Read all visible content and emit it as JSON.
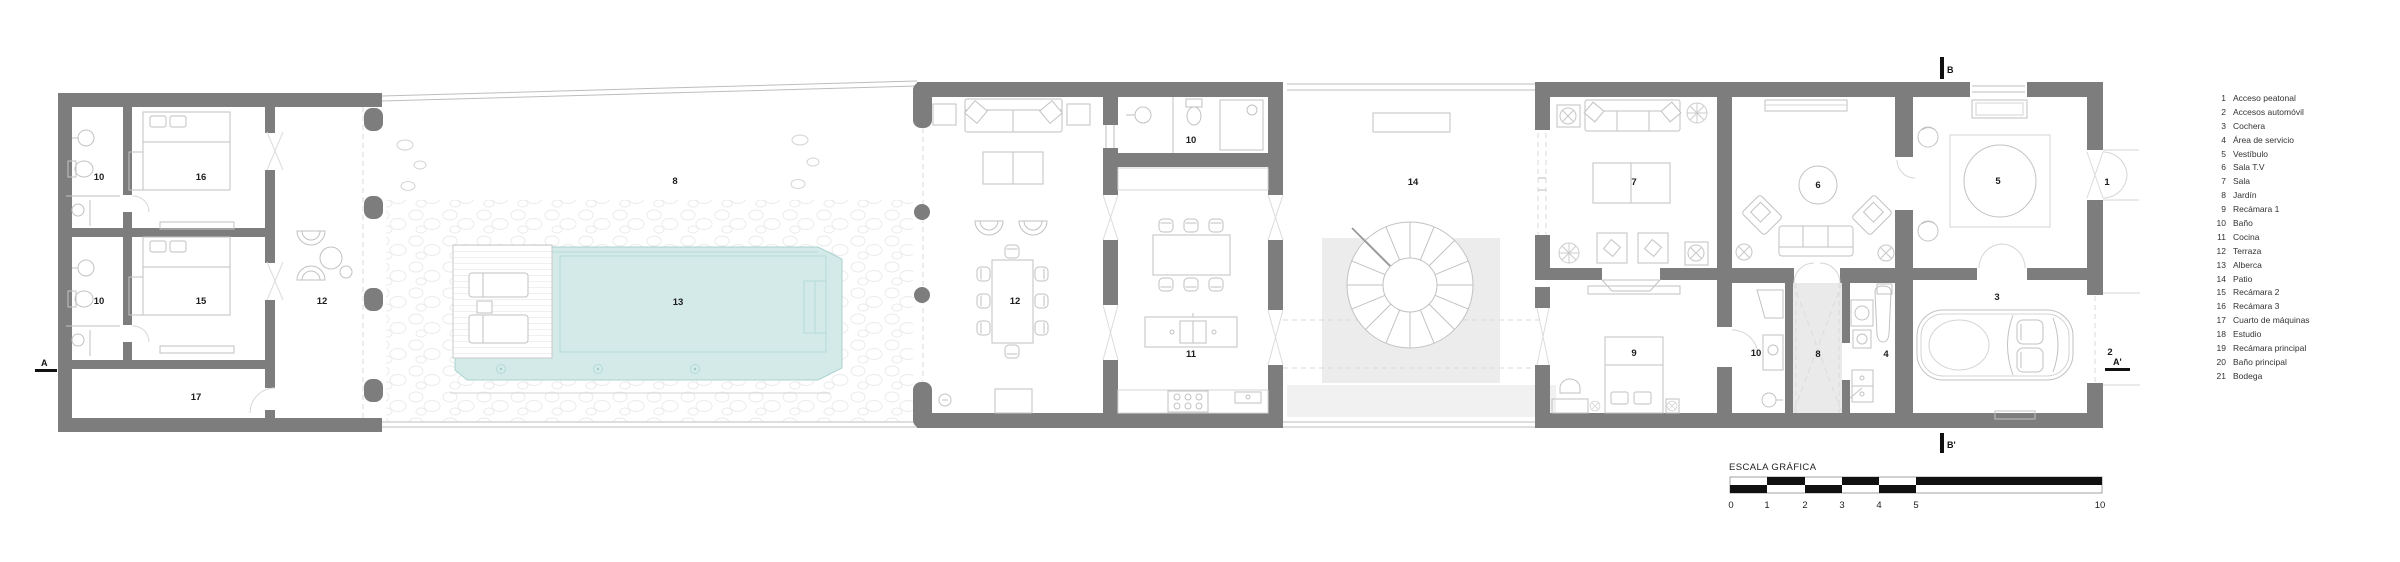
{
  "colors": {
    "wall": "#7d7d7d",
    "pool_water": "#d3eae8",
    "pool_edge": "#a9d3d0",
    "patio_paving": "#ececec",
    "service_courtyard": "#eaeaea",
    "furniture_line": "#c2c2c2",
    "label_text": "#1d1d1d",
    "legend_text": "#333333",
    "scale_black": "#111111"
  },
  "plan": {
    "labels": [
      {
        "text": "10"
      },
      {
        "text": "16"
      },
      {
        "text": "10"
      },
      {
        "text": "15"
      },
      {
        "text": "17"
      },
      {
        "text": "12"
      },
      {
        "text": "8"
      },
      {
        "text": "13"
      },
      {
        "text": "12"
      },
      {
        "text": "10"
      },
      {
        "text": "11"
      },
      {
        "text": "14"
      },
      {
        "text": "7"
      },
      {
        "text": "9"
      },
      {
        "text": "10"
      },
      {
        "text": "6"
      },
      {
        "text": "8"
      },
      {
        "text": "4"
      },
      {
        "text": "5"
      },
      {
        "text": "3"
      },
      {
        "text": "1"
      },
      {
        "text": "2"
      }
    ]
  },
  "section_markers": {
    "top": "B",
    "bottom": "B'",
    "left": "A",
    "right": "A'"
  },
  "scale_bar": {
    "title": "ESCALA GRÁFICA",
    "ticks": [
      "0",
      "1",
      "2",
      "3",
      "4",
      "5",
      "10"
    ]
  },
  "legend": {
    "items": [
      {
        "number": "1",
        "label": "Acceso peatonal"
      },
      {
        "number": "2",
        "label": "Accesos automóvil"
      },
      {
        "number": "3",
        "label": "Cochera"
      },
      {
        "number": "4",
        "label": "Área de servicio"
      },
      {
        "number": "5",
        "label": "Vestíbulo"
      },
      {
        "number": "6",
        "label": "Sala T.V"
      },
      {
        "number": "7",
        "label": "Sala"
      },
      {
        "number": "8",
        "label": "Jardín"
      },
      {
        "number": "9",
        "label": "Recámara 1"
      },
      {
        "number": "10",
        "label": "Baño"
      },
      {
        "number": "11",
        "label": "Cocina"
      },
      {
        "number": "12",
        "label": "Terraza"
      },
      {
        "number": "13",
        "label": "Alberca"
      },
      {
        "number": "14",
        "label": "Patio"
      },
      {
        "number": "15",
        "label": "Recámara 2"
      },
      {
        "number": "16",
        "label": "Recámara 3"
      },
      {
        "number": "17",
        "label": "Cuarto de máquinas"
      },
      {
        "number": "18",
        "label": "Estudio"
      },
      {
        "number": "19",
        "label": "Recámara principal"
      },
      {
        "number": "20",
        "label": "Baño principal"
      },
      {
        "number": "21",
        "label": "Bodega"
      }
    ]
  }
}
